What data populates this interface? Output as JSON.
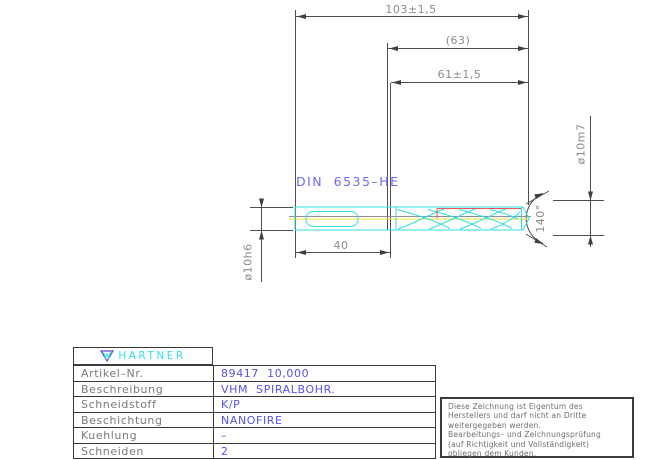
{
  "drawing": {
    "standard_label": "DIN 6535–HE",
    "dims": {
      "overall_length": "103±1,5",
      "aux_length": "(63)",
      "flute_length": "61±1,5",
      "shank_length": "40",
      "shank_diameter": "ø10h6",
      "cutting_diameter": "ø10m7",
      "point_angle": "140°"
    },
    "colors": {
      "outline_cyan": "#33dde4",
      "centerline_yellow": "#f0e23c",
      "detail_red": "#f25555",
      "dimension_gray": "#4e4e4e",
      "label_blue": "#6a6af8"
    }
  },
  "titleblock": {
    "brand": "HARTNER",
    "rows": [
      {
        "label": "Artikel–Nr.",
        "value": "89417 10,000"
      },
      {
        "label": "Beschreibung",
        "value": "VHM SPIRALBOHR."
      },
      {
        "label": "Schneidstoff",
        "value": "K/P"
      },
      {
        "label": "Beschichtung",
        "value": "NANOFIRE"
      },
      {
        "label": "Kuehlung",
        "value": "–"
      },
      {
        "label": "Schneiden",
        "value": "2"
      }
    ],
    "value_color": "#5353ef",
    "brand_color": "#35e3e9"
  },
  "note": {
    "lines": [
      "Diese Zeichnung ist Eigentum des",
      "Herstellers und darf nicht an Dritte",
      "weitergegeben werden.",
      "Bearbeitungs– und Zeichnungsprüfung",
      "(auf Richtigkeit und Vollständigkeit)",
      "obliegen dem Kunden."
    ]
  }
}
